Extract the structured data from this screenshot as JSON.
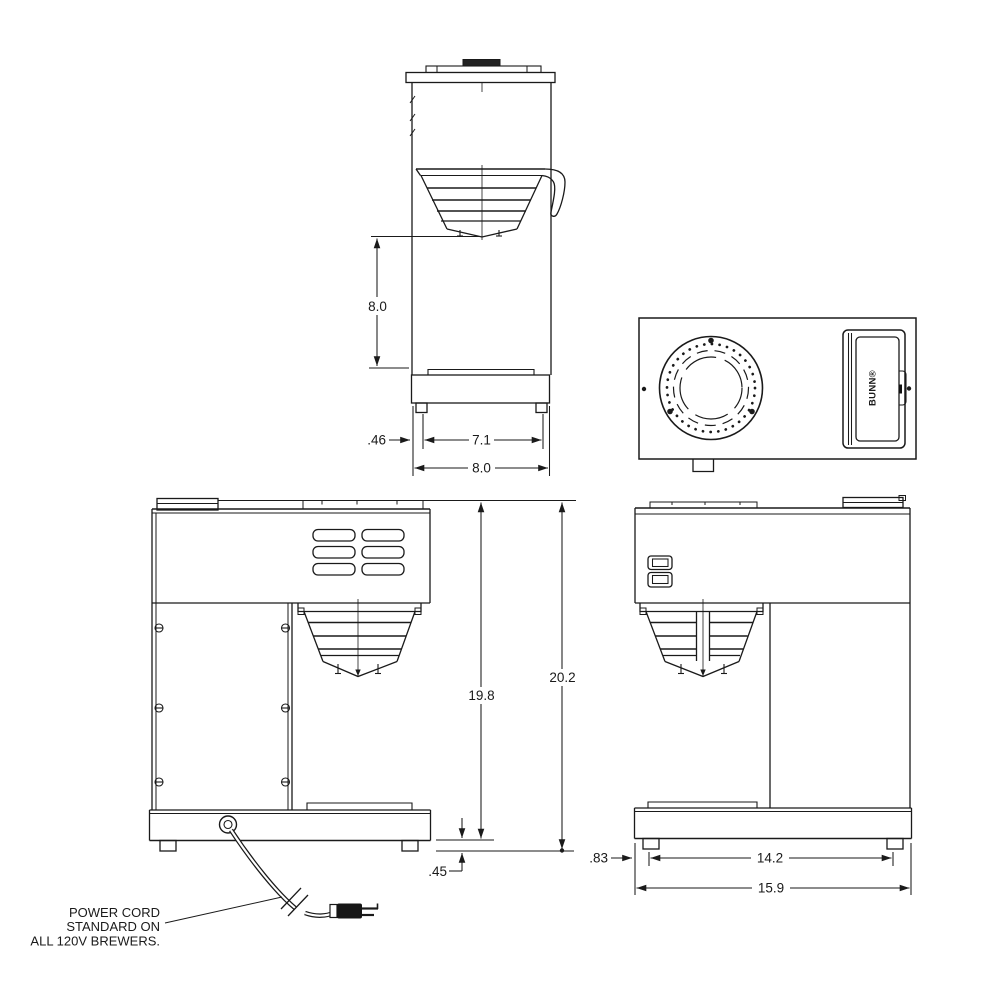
{
  "drawing": {
    "brand": "BUNN®",
    "note": {
      "line1": "POWER CORD",
      "line2": "STANDARD ON",
      "line3": "ALL 120V BREWERS."
    },
    "dims": {
      "side": {
        "funnel_to_base": "8.0",
        "foot_inset": ".46",
        "foot_span": "7.1",
        "depth": "8.0"
      },
      "front": {
        "body_height": "19.8",
        "overall_height": "20.2",
        "foot_height": ".45"
      },
      "rear": {
        "foot_inset": ".83",
        "foot_span": "14.2",
        "overall_width": "15.9"
      }
    },
    "colors": {
      "line": "#1a1a1a",
      "background": "#ffffff"
    }
  }
}
